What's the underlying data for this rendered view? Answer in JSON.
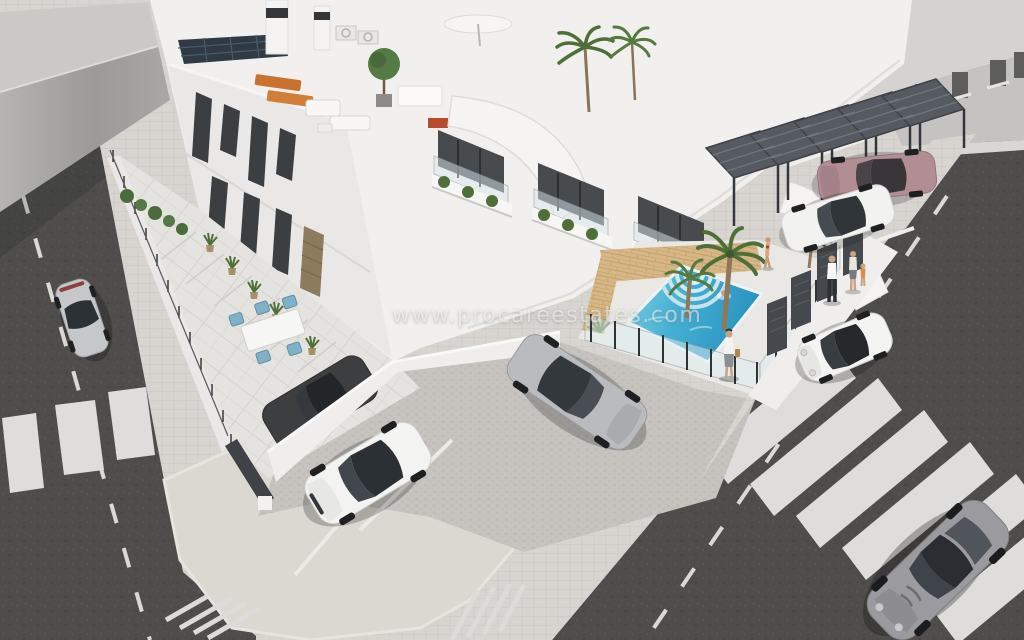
{
  "scene": {
    "type": "3D architectural visualization, aerial corner view",
    "subject": "New-build white townhouse complex with communal pool, parking court and surrounding streets",
    "watermark": "www.procareestates.com",
    "lighting": "bright daylight",
    "image_size": {
      "width": 1024,
      "height": 640
    }
  },
  "palette": {
    "asphalt": "#4e4d4b",
    "road_marking": "#e9e9e7",
    "sidewalk": "#d8d5d1",
    "paver_court": "#c7c4c0",
    "corner_platform": "#dbd8d2",
    "building_white": "#f1f0ee",
    "facade_shade": "#e9e8e6",
    "window_glass": "#3b3f42",
    "loggia_shadow": "#474b4e",
    "timber_slats": "#8d7b5d",
    "pool_deck_wood": "#d7b787",
    "pool_deep": "#2b93c0",
    "pool_shallow": "#7fcfe2",
    "greenery": "#4e7038",
    "carport_steel": "#565b62",
    "neighbor_grey": "#c4c3c1"
  },
  "site": {
    "streets": [
      {
        "name": "left-street",
        "features": [
          "dashed centre line",
          "zebra crossing",
          "parked silver coupe"
        ]
      },
      {
        "name": "right-street",
        "features": [
          "dashed centre line",
          "zebra crossing",
          "white mini",
          "grey sports car"
        ]
      }
    ],
    "markings": [
      "corner pedestrian platform",
      "diagonal hatched zones",
      "white parking bay lines"
    ],
    "complex": {
      "floors": 3,
      "features": [
        "stepped white volumes",
        "roof terraces",
        "glass balustrade balconies",
        "angular dark window recesses",
        "timber slat doors",
        "curved sculptural parapets",
        "external stairs",
        "hanging plants"
      ]
    },
    "roof_terrace_items": [
      "solar panel array",
      "two chimneys",
      "air-conditioning units",
      "orange sun loungers",
      "white lounge sofa set",
      "potted trees",
      "white parasol",
      "barbecue table"
    ],
    "garden": [
      "tiled side walkway",
      "hedge row",
      "spiky potted plants",
      "outdoor dining table with blue chairs"
    ],
    "pool_area": [
      "rectangular pool",
      "fan-shaped roman steps",
      "timber deck",
      "palm trees",
      "agave",
      "glass safety fence",
      "outdoor shower",
      "dark entrance gates"
    ],
    "parking": [
      "louvred pergola carports",
      "paved parking court"
    ],
    "neighbours": [
      "grey terraced houses with pitched roof (top right)",
      "grey boundary wall (top left)"
    ]
  },
  "vehicles": [
    {
      "name": "silver-coupe",
      "color": "#c6c7c9",
      "location": "parked on left street"
    },
    {
      "name": "dark-grey-saloon",
      "color": "#3c3e40",
      "location": "behind privacy wall inside plot"
    },
    {
      "name": "white-audi-tt-coupe",
      "color": "#f3f3f1",
      "location": "angled bay in parking court"
    },
    {
      "name": "silver-mercedes-saloon",
      "color": "#babbbe",
      "location": "parking court in front of pool fence"
    },
    {
      "name": "rose-gold-mercedes-cls",
      "color": "#b28d94",
      "location": "under carport pergola"
    },
    {
      "name": "white-saloon",
      "color": "#f2f2f0",
      "location": "carport parking bay"
    },
    {
      "name": "white-mini-cooper",
      "color": "#f4f4f2",
      "location": "on right street beside pool wall"
    },
    {
      "name": "grey-aston-martin",
      "color": "#9b9b9f",
      "location": "driving on right street, bottom right"
    }
  ],
  "people": [
    {
      "name": "swimmer",
      "location": "in pool"
    },
    {
      "name": "sunbather-in-bikini",
      "location": "standing on pool deck"
    },
    {
      "name": "woman-with-bag",
      "location": "walking on pavement beside pool fence"
    },
    {
      "name": "man-white-shirt",
      "location": "standing by entrance gates"
    },
    {
      "name": "woman-and-child",
      "location": "standing by entrance gates"
    }
  ]
}
